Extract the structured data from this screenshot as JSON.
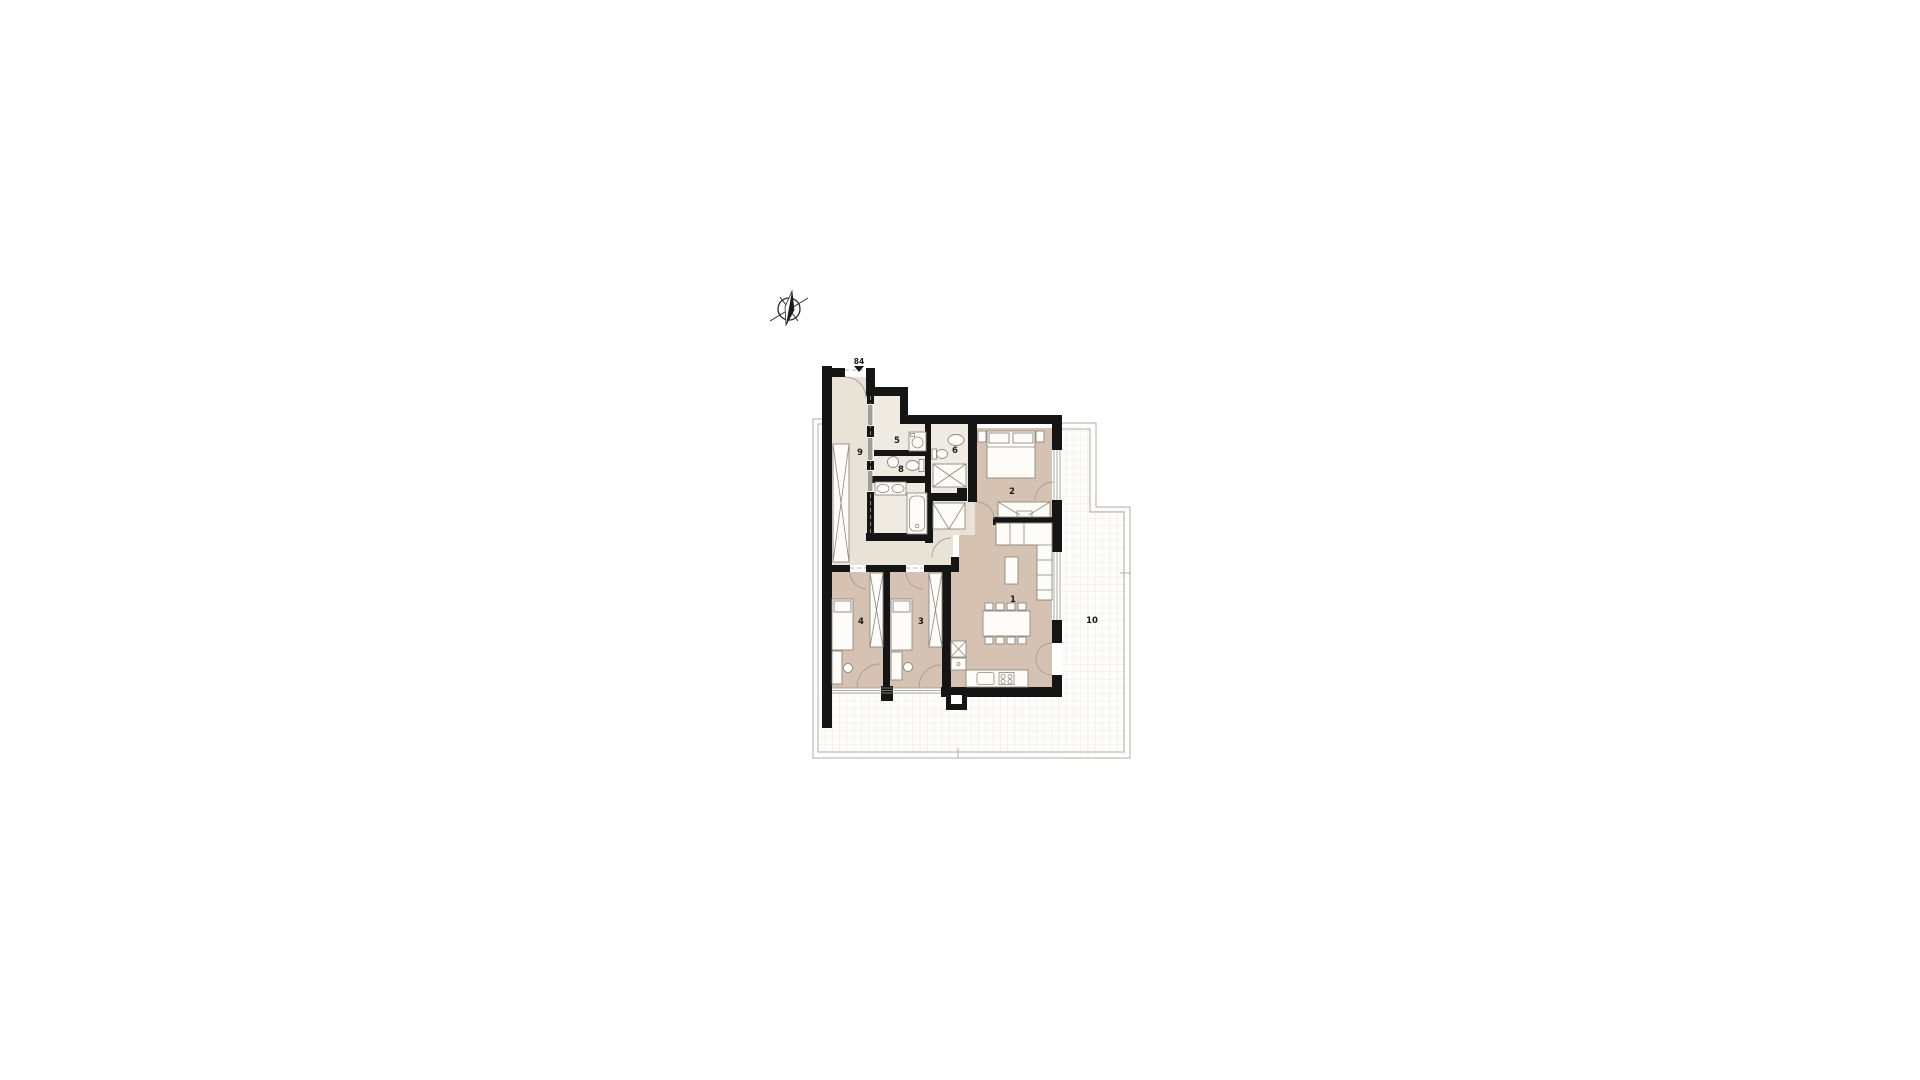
{
  "colors": {
    "bg": "#ffffff",
    "wall": "#151515",
    "floor-hall": "#e9e3d7",
    "floor-wet": "#efebe3",
    "floor-room": "#d6c2b3",
    "grid-line": "#e9e1d9",
    "outline": "#b3aca5",
    "furniture-stroke": "#8e8880",
    "door-stroke": "#a49d95",
    "label": "#1a1a1a"
  },
  "labels": {
    "living_room": "1",
    "master_bedroom": "2",
    "bedroom_middle": "3",
    "bedroom_left": "4",
    "laundry": "5",
    "shower_room": "6",
    "wc": "8",
    "hallway": "9",
    "terrace": "10",
    "entrance_number": "84"
  }
}
